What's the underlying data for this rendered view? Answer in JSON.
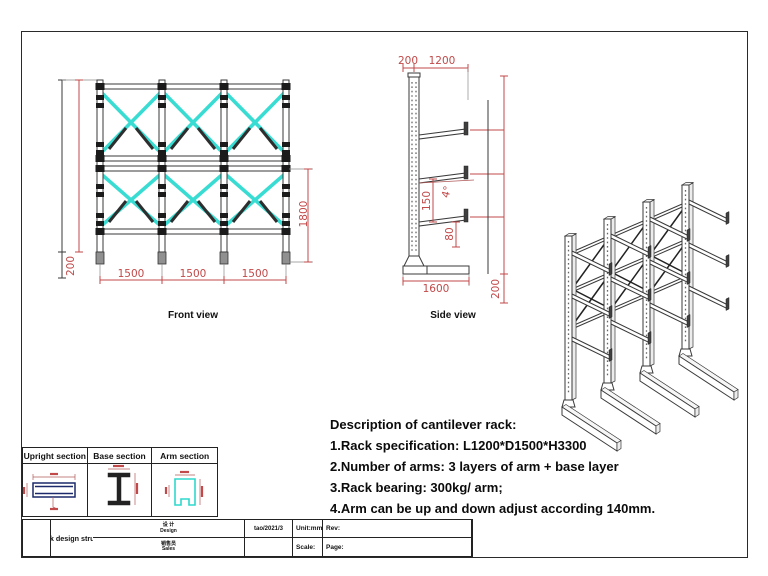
{
  "front_view": {
    "label": "Front view",
    "dim_left_height": "200",
    "dim_bays": [
      "1500",
      "1500",
      "1500"
    ],
    "dim_level_height": "1800"
  },
  "side_view": {
    "label": "Side view",
    "dim_top_left": "200",
    "dim_top_right": "1200",
    "dim_angle": "4°",
    "dim_arm_spacing": "150",
    "dim_arm_offset": "80",
    "dim_base_width": "1600",
    "dim_base_height": "200"
  },
  "sections": {
    "upright_header": "Upright section",
    "base_header": "Base section",
    "arm_header": "Arm section"
  },
  "description": {
    "title": "Description of cantilever rack:",
    "line1": "1.Rack specification: L1200*D1500*H3300",
    "line2": "2.Number of arms: 3 layers of arm + base layer",
    "line3": "3.Rack bearing: 300kg/ arm;",
    "line4": "4.Arm can be up and down adjust according 140mm."
  },
  "title_block": {
    "design_label_cn": "设 计",
    "design_label_en": "Design",
    "design_value": "tao/2021/3",
    "sales_label_cn": "销售员",
    "sales_label_en": "Sales",
    "unit_label": "Unit:mm",
    "rev_label": "Rev:",
    "scale_label": "Scale:",
    "page_label": "Page:",
    "drawing_title": "Cantilever rack design structure drawing"
  },
  "colors": {
    "dimension_red": "#c14949",
    "brace_cyan": "#38dcd2",
    "line_dark": "#2a2a2a"
  }
}
